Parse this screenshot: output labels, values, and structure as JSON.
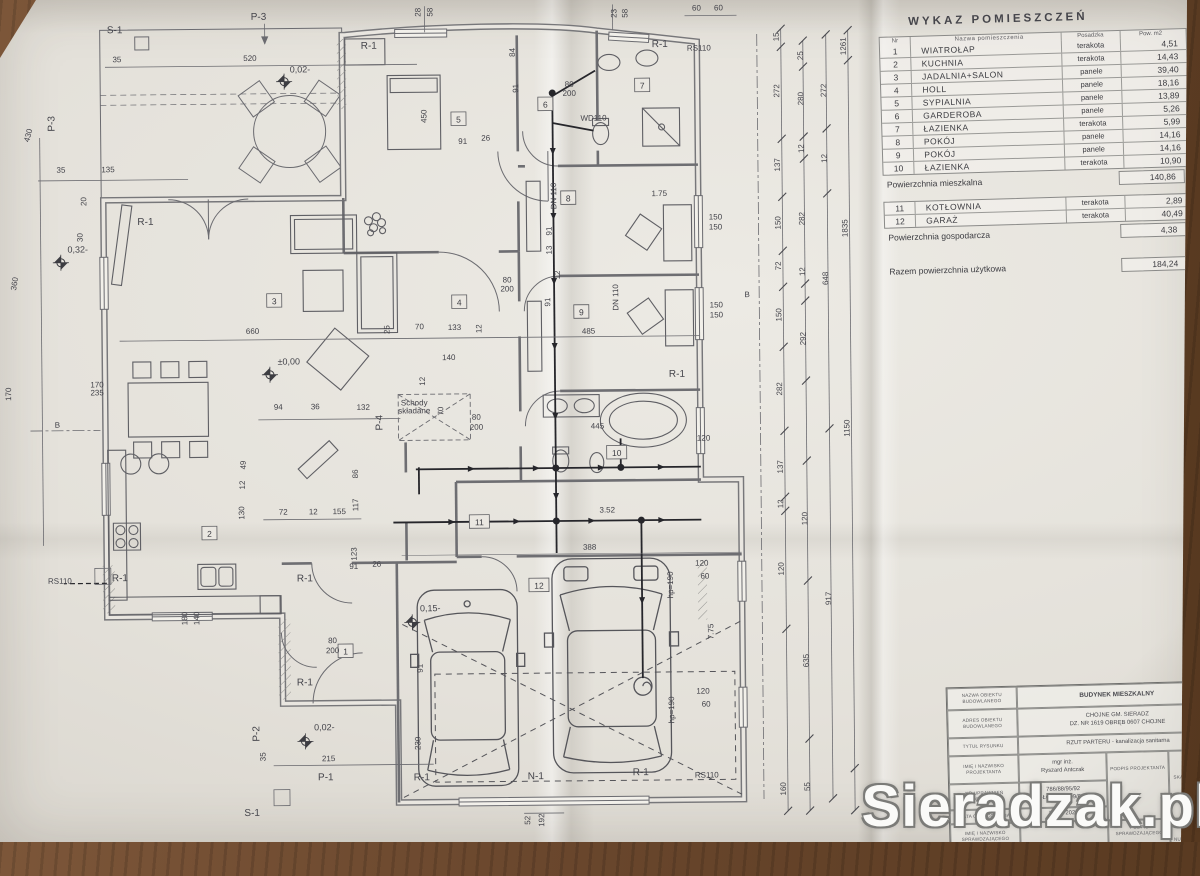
{
  "watermark": "Sieradzak.pl",
  "room_table": {
    "title": "WYKAZ POMIESZCZEŃ",
    "headers": {
      "nr": "Nr",
      "name": "Nazwa pomieszczenia",
      "floor": "Posadzka",
      "area": "Pow. m2"
    },
    "rows": [
      {
        "nr": "1",
        "name": "WIATROŁAP",
        "floor": "terakota",
        "area": "4,51"
      },
      {
        "nr": "2",
        "name": "KUCHNIA",
        "floor": "terakota",
        "area": "14,43"
      },
      {
        "nr": "3",
        "name": "JADALNIA+SALON",
        "floor": "panele",
        "area": "39,40"
      },
      {
        "nr": "4",
        "name": "HOLL",
        "floor": "panele",
        "area": "18,16"
      },
      {
        "nr": "5",
        "name": "SYPIALNIA",
        "floor": "panele",
        "area": "13,89"
      },
      {
        "nr": "6",
        "name": "GARDEROBA",
        "floor": "panele",
        "area": "5,26"
      },
      {
        "nr": "7",
        "name": "ŁAZIENKA",
        "floor": "terakota",
        "area": "5,99"
      },
      {
        "nr": "8",
        "name": "POKÓJ",
        "floor": "panele",
        "area": "14,16"
      },
      {
        "nr": "9",
        "name": "POKÓJ",
        "floor": "panele",
        "area": "14,16"
      },
      {
        "nr": "10",
        "name": "ŁAZIENKA",
        "floor": "terakota",
        "area": "10,90"
      }
    ],
    "living_sum": {
      "label": "Powierzchnia mieszkalna",
      "value": "140,86"
    },
    "aux_rows": [
      {
        "nr": "11",
        "name": "KOTŁOWNIA",
        "floor": "terakota",
        "area": "2,89"
      },
      {
        "nr": "12",
        "name": "GARAŻ",
        "floor": "terakota",
        "area": "40,49"
      }
    ],
    "aux_sum": {
      "label": "Powierzchnia gospodarcza",
      "value": "4,38"
    },
    "total": {
      "label": "Razem powierzchnia użytkowa",
      "value": "184,24"
    }
  },
  "title_block": {
    "r1": {
      "label": "NAZWA OBIEKTU BUDOWLANEGO",
      "value": "BUDYNEK MIESZKALNY"
    },
    "r2": {
      "label": "ADRES OBIEKTU BUDOWLANEGO",
      "value": "CHOJNE GM. SIERADZ",
      "value2": "DZ. NR 1619 OBRĘB 0607 CHOJNE"
    },
    "r3": {
      "label": "TYTUŁ RYSUNKU",
      "value": "RZUT PARTERU - kanalizacja sanitarna"
    },
    "r4": {
      "label": "IMIĘ I NAZWISKO PROJEKTANTA",
      "value": "mgr inż.",
      "value2": "Ryszard Antczak"
    },
    "r5": {
      "label": "NR UPRAWNIEŃ BUDOWLANYCH",
      "value": "786/88/95/92",
      "value2": "ŁOD/IS/3309/01"
    },
    "r6": {
      "label": "DATA OPRACOWANIA",
      "value": "LUTY 2024"
    },
    "r7": {
      "label": "IMIĘ I NAZWISKO SPRAWDZAJĄCEGO",
      "value": ""
    },
    "r8": {
      "label": "NR UPRAWNIEŃ BUDOWLANYCH",
      "value": ""
    },
    "podpis_projektanta": "PODPIS PROJEKTANTA",
    "podpis_sprawdzajacego": "PODPIS SPRAWDZAJĄCEGO",
    "skala_label": "SKALA RYSUNKU",
    "skala_value": "1:50",
    "numer_label": "NUMER RYSUNKU"
  },
  "plan": {
    "room_numbers": [
      {
        "n": "1",
        "x": 343,
        "y": 648
      },
      {
        "n": "2",
        "x": 208,
        "y": 529
      },
      {
        "n": "3",
        "x": 275,
        "y": 297
      },
      {
        "n": "4",
        "x": 460,
        "y": 300
      },
      {
        "n": "5",
        "x": 461,
        "y": 117
      },
      {
        "n": "6",
        "x": 548,
        "y": 103
      },
      {
        "n": "7",
        "x": 645,
        "y": 85
      },
      {
        "n": "8",
        "x": 570,
        "y": 197
      },
      {
        "n": "9",
        "x": 582,
        "y": 311
      },
      {
        "n": "10",
        "x": 616,
        "y": 452
      },
      {
        "n": "11",
        "x": 478,
        "y": 520
      },
      {
        "n": "12",
        "x": 537,
        "y": 584
      }
    ],
    "annotations": [
      {
        "t": "S-1",
        "x": 118,
        "y": 28,
        "c": "lb"
      },
      {
        "t": "P-3",
        "x": 262,
        "y": 16,
        "c": "lb"
      },
      {
        "t": "P-3",
        "x": 57,
        "y": 118,
        "r": -90,
        "c": "lb"
      },
      {
        "t": "R-1",
        "x": 372,
        "y": 46,
        "c": "lb"
      },
      {
        "t": "R-1",
        "x": 663,
        "y": 47,
        "c": "lb"
      },
      {
        "t": "RS110",
        "x": 702,
        "y": 51,
        "s": 8
      },
      {
        "t": "R-1",
        "x": 147,
        "y": 220,
        "c": "lb"
      },
      {
        "t": "B",
        "x": 57,
        "y": 422,
        "s": 11
      },
      {
        "t": "B",
        "x": 748,
        "y": 298,
        "s": 11
      },
      {
        "t": "RS110",
        "x": 58,
        "y": 578,
        "s": 8
      },
      {
        "t": "R-1",
        "x": 118,
        "y": 576,
        "c": "lb"
      },
      {
        "t": "R-1",
        "x": 303,
        "y": 578,
        "c": "lb"
      },
      {
        "t": "R-1",
        "x": 677,
        "y": 377,
        "c": "lb"
      },
      {
        "t": "R-1",
        "x": 302,
        "y": 682,
        "c": "lb"
      },
      {
        "t": "P-2",
        "x": 256,
        "y": 730,
        "r": -90,
        "c": "lb"
      },
      {
        "t": "P-1",
        "x": 322,
        "y": 777,
        "c": "lb"
      },
      {
        "t": "S-1",
        "x": 248,
        "y": 812,
        "c": "lb"
      },
      {
        "t": "R-1",
        "x": 418,
        "y": 778,
        "c": "lb"
      },
      {
        "t": "N-1",
        "x": 532,
        "y": 778,
        "c": "lb"
      },
      {
        "t": "R-1",
        "x": 637,
        "y": 775,
        "c": "lb"
      },
      {
        "t": "RS110",
        "x": 703,
        "y": 778,
        "s": 8
      },
      {
        "t": "P-4",
        "x": 382,
        "y": 420,
        "r": -90,
        "c": "lb"
      },
      {
        "t": "WD110",
        "x": 596,
        "y": 120,
        "s": 6.5
      },
      {
        "t": "Schody",
        "x": 414,
        "y": 403,
        "s": 6
      },
      {
        "t": "składane",
        "x": 414,
        "y": 411,
        "s": 6
      },
      {
        "t": "DN 110",
        "x": 619,
        "y": 297,
        "r": -90,
        "s": 6
      },
      {
        "t": "DN 110",
        "x": 558,
        "y": 195,
        "r": -90,
        "s": 6
      },
      {
        "t": "hp=190",
        "x": 671,
        "y": 585,
        "r": -90,
        "s": 6
      },
      {
        "t": "hp=190",
        "x": 671,
        "y": 710,
        "r": -90,
        "s": 6
      },
      {
        "t": "0,02-",
        "x": 303,
        "y": 69,
        "c": "lvl"
      },
      {
        "t": "±0,00",
        "x": 289,
        "y": 361,
        "c": "lvl"
      },
      {
        "t": "0,32-",
        "x": 79,
        "y": 247,
        "c": "lvl"
      },
      {
        "t": "0,15-",
        "x": 428,
        "y": 609,
        "c": "lvl"
      },
      {
        "t": "0,02-",
        "x": 321,
        "y": 727,
        "c": "lvl"
      },
      {
        "t": "520",
        "x": 253,
        "y": 57,
        "s": 7
      },
      {
        "t": "35",
        "x": 120,
        "y": 57,
        "s": 6
      },
      {
        "t": "35",
        "x": 63,
        "y": 167,
        "s": 6
      },
      {
        "t": "135",
        "x": 110,
        "y": 167,
        "s": 7
      },
      {
        "t": "20",
        "x": 88,
        "y": 196,
        "r": -90,
        "s": 6
      },
      {
        "t": "30",
        "x": 84,
        "y": 232,
        "r": -90,
        "s": 6
      },
      {
        "t": "430",
        "x": 33,
        "y": 130,
        "r": -75,
        "s": 7
      },
      {
        "t": "360",
        "x": 18,
        "y": 278,
        "r": -80,
        "s": 7
      },
      {
        "t": "170",
        "x": 11,
        "y": 388,
        "r": -90,
        "s": 7
      },
      {
        "t": "170",
        "x": 97,
        "y": 382,
        "s": 5.5
      },
      {
        "t": "235",
        "x": 97,
        "y": 390,
        "s": 5.5
      },
      {
        "t": "660",
        "x": 253,
        "y": 330,
        "s": 7
      },
      {
        "t": "25",
        "x": 390,
        "y": 327,
        "r": -90,
        "s": 6
      },
      {
        "t": "70",
        "x": 420,
        "y": 327,
        "s": 6.5
      },
      {
        "t": "133",
        "x": 455,
        "y": 328,
        "s": 7
      },
      {
        "t": "12",
        "x": 482,
        "y": 327,
        "r": -90,
        "s": 6
      },
      {
        "t": "485",
        "x": 589,
        "y": 333,
        "s": 7
      },
      {
        "t": "94",
        "x": 278,
        "y": 406,
        "s": 6.5
      },
      {
        "t": "36",
        "x": 315,
        "y": 406,
        "s": 6.5
      },
      {
        "t": "132",
        "x": 363,
        "y": 407,
        "s": 7
      },
      {
        "t": "140",
        "x": 449,
        "y": 358,
        "s": 7
      },
      {
        "t": "12",
        "x": 425,
        "y": 379,
        "r": -90,
        "s": 6
      },
      {
        "t": "70",
        "x": 443,
        "y": 409,
        "r": -90,
        "s": 6
      },
      {
        "t": "445",
        "x": 597,
        "y": 428,
        "s": 7
      },
      {
        "t": "3.52",
        "x": 606,
        "y": 512,
        "s": 7
      },
      {
        "t": "388",
        "x": 588,
        "y": 549,
        "s": 7
      },
      {
        "t": "215",
        "x": 325,
        "y": 758,
        "s": 7
      },
      {
        "t": "35",
        "x": 262,
        "y": 753,
        "r": -90,
        "s": 6
      },
      {
        "t": "91",
        "x": 420,
        "y": 666,
        "r": -90,
        "s": 6.5
      },
      {
        "t": "230",
        "x": 417,
        "y": 741,
        "r": -90,
        "s": 6.5
      },
      {
        "t": "52",
        "x": 526,
        "y": 819,
        "r": -90,
        "s": 6
      },
      {
        "t": "192",
        "x": 540,
        "y": 819,
        "r": -90,
        "s": 6
      },
      {
        "t": "180",
        "x": 185,
        "y": 614,
        "r": -90,
        "s": 6
      },
      {
        "t": "140",
        "x": 197,
        "y": 614,
        "r": -90,
        "s": 6
      },
      {
        "t": "130",
        "x": 243,
        "y": 509,
        "r": -90,
        "s": 6.5
      },
      {
        "t": "12",
        "x": 244,
        "y": 481,
        "r": -90,
        "s": 6
      },
      {
        "t": "49",
        "x": 245,
        "y": 461,
        "r": -90,
        "s": 6
      },
      {
        "t": "72",
        "x": 282,
        "y": 511,
        "s": 6.5
      },
      {
        "t": "12",
        "x": 312,
        "y": 511,
        "s": 6
      },
      {
        "t": "155",
        "x": 338,
        "y": 511,
        "s": 7
      },
      {
        "t": "117",
        "x": 357,
        "y": 502,
        "r": -90,
        "s": 6.5
      },
      {
        "t": "86",
        "x": 357,
        "y": 471,
        "r": -90,
        "s": 6
      },
      {
        "t": "91",
        "x": 352,
        "y": 566,
        "s": 6.5
      },
      {
        "t": "26",
        "x": 375,
        "y": 564,
        "s": 6
      },
      {
        "t": "123",
        "x": 355,
        "y": 551,
        "r": -90,
        "s": 6.5
      },
      {
        "t": "91",
        "x": 465,
        "y": 142,
        "s": 6.5
      },
      {
        "t": "26",
        "x": 488,
        "y": 139,
        "s": 6
      },
      {
        "t": "450",
        "x": 429,
        "y": 114,
        "r": -90,
        "s": 7
      },
      {
        "t": "84",
        "x": 518,
        "y": 51,
        "r": -90,
        "s": 6
      },
      {
        "t": "91",
        "x": 521,
        "y": 87,
        "r": -90,
        "s": 6.5
      },
      {
        "t": "80",
        "x": 508,
        "y": 281,
        "s": 5.5
      },
      {
        "t": "200",
        "x": 508,
        "y": 290,
        "s": 5.5
      },
      {
        "t": "80",
        "x": 572,
        "y": 86,
        "s": 5.5
      },
      {
        "t": "200",
        "x": 572,
        "y": 95,
        "s": 5.5
      },
      {
        "t": "80",
        "x": 476,
        "y": 418,
        "s": 5.5
      },
      {
        "t": "200",
        "x": 476,
        "y": 428,
        "s": 5.5
      },
      {
        "t": "80",
        "x": 330,
        "y": 640,
        "s": 5.5
      },
      {
        "t": "200",
        "x": 330,
        "y": 650,
        "s": 5.5
      },
      {
        "t": "150",
        "x": 717,
        "y": 220,
        "s": 6
      },
      {
        "t": "150",
        "x": 717,
        "y": 230,
        "s": 6
      },
      {
        "t": "150",
        "x": 717,
        "y": 308,
        "s": 6
      },
      {
        "t": "150",
        "x": 717,
        "y": 318,
        "s": 6
      },
      {
        "t": "1.75",
        "x": 661,
        "y": 196,
        "s": 6
      },
      {
        "t": "7.75",
        "x": 711,
        "y": 632,
        "r": -90,
        "s": 6
      },
      {
        "t": "120",
        "x": 700,
        "y": 566,
        "s": 6
      },
      {
        "t": "60",
        "x": 703,
        "y": 579,
        "s": 6
      },
      {
        "t": "120",
        "x": 700,
        "y": 694,
        "s": 6
      },
      {
        "t": "60",
        "x": 703,
        "y": 707,
        "s": 6
      },
      {
        "t": "120",
        "x": 703,
        "y": 441,
        "s": 6
      },
      {
        "t": "91",
        "x": 553,
        "y": 230,
        "r": -90,
        "s": 6
      },
      {
        "t": "13",
        "x": 553,
        "y": 249,
        "r": -90,
        "s": 6
      },
      {
        "t": "12",
        "x": 561,
        "y": 274,
        "r": -90,
        "s": 6
      },
      {
        "t": "91",
        "x": 551,
        "y": 301,
        "r": -90,
        "s": 6
      },
      {
        "t": "23",
        "x": 620,
        "y": 13,
        "r": -90,
        "s": 5.5
      },
      {
        "t": "58",
        "x": 631,
        "y": 13,
        "r": -90,
        "s": 5.5
      },
      {
        "t": "28",
        "x": 424,
        "y": 10,
        "r": -90,
        "s": 5.5
      },
      {
        "t": "58",
        "x": 436,
        "y": 10,
        "r": -90,
        "s": 5.5
      },
      {
        "t": "60",
        "x": 700,
        "y": 11,
        "s": 6
      },
      {
        "t": "60",
        "x": 722,
        "y": 11,
        "s": 6
      },
      {
        "t": "15",
        "x": 782,
        "y": 38,
        "r": -90,
        "s": 7
      },
      {
        "t": "272",
        "x": 782,
        "y": 92,
        "r": -90,
        "s": 7
      },
      {
        "t": "137",
        "x": 782,
        "y": 166,
        "r": -90,
        "s": 7
      },
      {
        "t": "150",
        "x": 782,
        "y": 224,
        "r": -90,
        "s": 7
      },
      {
        "t": "72",
        "x": 782,
        "y": 267,
        "r": -90,
        "s": 7
      },
      {
        "t": "150",
        "x": 782,
        "y": 316,
        "r": -90,
        "s": 7
      },
      {
        "t": "282",
        "x": 782,
        "y": 390,
        "r": -90,
        "s": 7
      },
      {
        "t": "137",
        "x": 782,
        "y": 468,
        "r": -90,
        "s": 7
      },
      {
        "t": "12",
        "x": 782,
        "y": 505,
        "r": -90,
        "s": 6
      },
      {
        "t": "120",
        "x": 782,
        "y": 570,
        "r": -90,
        "s": 7
      },
      {
        "t": "160",
        "x": 782,
        "y": 790,
        "r": -90,
        "s": 7
      },
      {
        "t": "25",
        "x": 806,
        "y": 57,
        "r": -90,
        "s": 7
      },
      {
        "t": "280",
        "x": 806,
        "y": 100,
        "r": -90,
        "s": 7
      },
      {
        "t": "12",
        "x": 806,
        "y": 150,
        "r": -90,
        "s": 6
      },
      {
        "t": "282",
        "x": 806,
        "y": 220,
        "r": -90,
        "s": 7
      },
      {
        "t": "12",
        "x": 806,
        "y": 273,
        "r": -90,
        "s": 6
      },
      {
        "t": "292",
        "x": 806,
        "y": 340,
        "r": -90,
        "s": 7
      },
      {
        "t": "120",
        "x": 806,
        "y": 520,
        "r": -90,
        "s": 7
      },
      {
        "t": "635",
        "x": 806,
        "y": 662,
        "r": -90,
        "s": 7
      },
      {
        "t": "55",
        "x": 806,
        "y": 788,
        "r": -90,
        "s": 7
      },
      {
        "t": "272",
        "x": 829,
        "y": 92,
        "r": -90,
        "s": 7
      },
      {
        "t": "12",
        "x": 829,
        "y": 160,
        "r": -90,
        "s": 6
      },
      {
        "t": "648",
        "x": 829,
        "y": 280,
        "r": -90,
        "s": 7
      },
      {
        "t": "917",
        "x": 829,
        "y": 600,
        "r": -90,
        "s": 7
      },
      {
        "t": "1150",
        "x": 849,
        "y": 430,
        "r": -90,
        "s": 7
      },
      {
        "t": "1835",
        "x": 849,
        "y": 230,
        "r": -90,
        "s": 7
      },
      {
        "t": "1261",
        "x": 849,
        "y": 48,
        "r": -90,
        "s": 6.5
      }
    ],
    "chains": [
      {
        "x": 784,
        "y1": 30,
        "y2": 812,
        "ticks": [
          30,
          48,
          140,
          198,
          252,
          288,
          348,
          432,
          498,
          512,
          630,
          812
        ]
      },
      {
        "x": 806,
        "y1": 42,
        "y2": 812,
        "ticks": [
          42,
          68,
          138,
          160,
          285,
          302,
          382,
          462,
          582,
          740,
          812
        ]
      },
      {
        "x": 829,
        "y1": 36,
        "y2": 800,
        "ticks": [
          36,
          130,
          195,
          430,
          800
        ]
      },
      {
        "x": 851,
        "y1": 32,
        "y2": 812,
        "ticks": [
          32,
          62,
          770,
          812
        ]
      }
    ]
  }
}
